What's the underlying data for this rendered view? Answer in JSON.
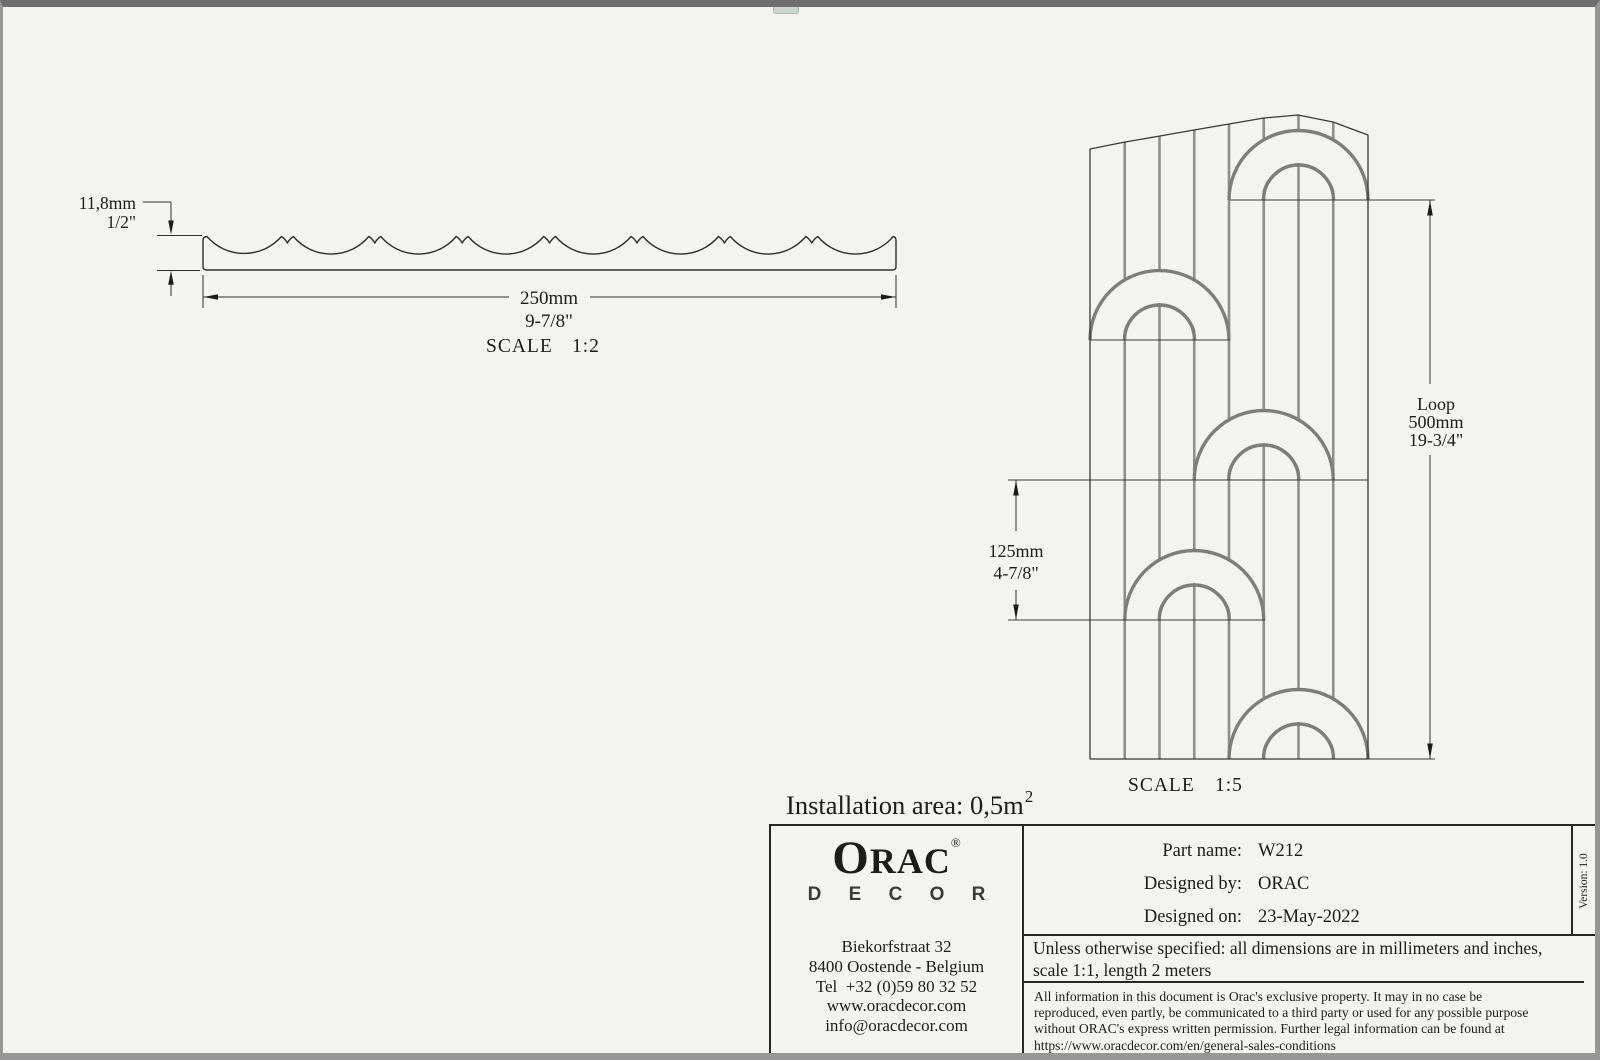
{
  "colors": {
    "background": "#f3f3f1",
    "outline": "#2f2f2f",
    "flute_gray": "#8e8e8e",
    "arch_gray": "#7d7d7d",
    "border_gray": "#979797",
    "titleblock_border": "#262626"
  },
  "profile_view": {
    "dim_height_mm": "11,8mm",
    "dim_height_in": "1/2\"",
    "dim_width_mm": "250mm",
    "dim_width_in": "9-7/8\"",
    "scale_label": "SCALE",
    "scale_value": "1:2"
  },
  "front_view": {
    "dim_loop_label": "Loop",
    "dim_loop_mm": "500mm",
    "dim_loop_in": "19-3/4\"",
    "dim_repeat_mm": "125mm",
    "dim_repeat_in": "4-7/8\"",
    "scale_label": "SCALE",
    "scale_value": "1:5"
  },
  "installation_area": {
    "label": "Installation area:",
    "value": " 0,5m",
    "superscript": "2"
  },
  "title_block": {
    "logo": {
      "letter_o": "O",
      "letters_rac": "RAC",
      "registered": "®",
      "sub_brand": "D E C O R"
    },
    "address_lines": [
      "Biekorfstraat 32",
      "8400 Oostende - Belgium",
      "Tel  +32 (0)59 80 32 52",
      "www.oracdecor.com",
      "info@oracdecor.com"
    ],
    "fields": [
      {
        "label": "Part name:",
        "value": "W212"
      },
      {
        "label": "Designed by:",
        "value": "ORAC"
      },
      {
        "label": "Designed on:",
        "value": "23-May-2022"
      }
    ],
    "version": "Version: 1.0",
    "notes": "Unless otherwise specified: all dimensions are in millimeters and inches, scale 1:1, length 2 meters",
    "legal": "All information in this document is Orac's exclusive property.  It may in no case be reproduced, even partly, be communicated to a third party or used for any possible purpose without ORAC's express written permission. Further legal information can be found at https://www.oracdecor.com/en/general-sales-conditions"
  }
}
